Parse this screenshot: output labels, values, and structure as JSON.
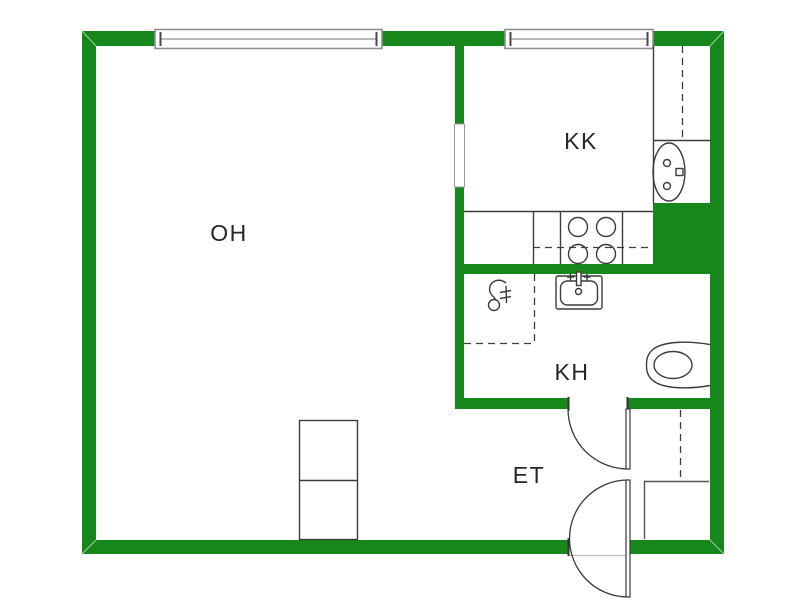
{
  "floorplan": {
    "wall_color": "#17871b",
    "background_color": "#ffffff",
    "fixture_line_color": "#3c3c3c",
    "window_line_color": "#8f8f8f",
    "rooms": [
      {
        "id": "oh",
        "label": "OH"
      },
      {
        "id": "kk",
        "label": "KK"
      },
      {
        "id": "kh",
        "label": "KH"
      },
      {
        "id": "et",
        "label": "ET"
      }
    ]
  }
}
